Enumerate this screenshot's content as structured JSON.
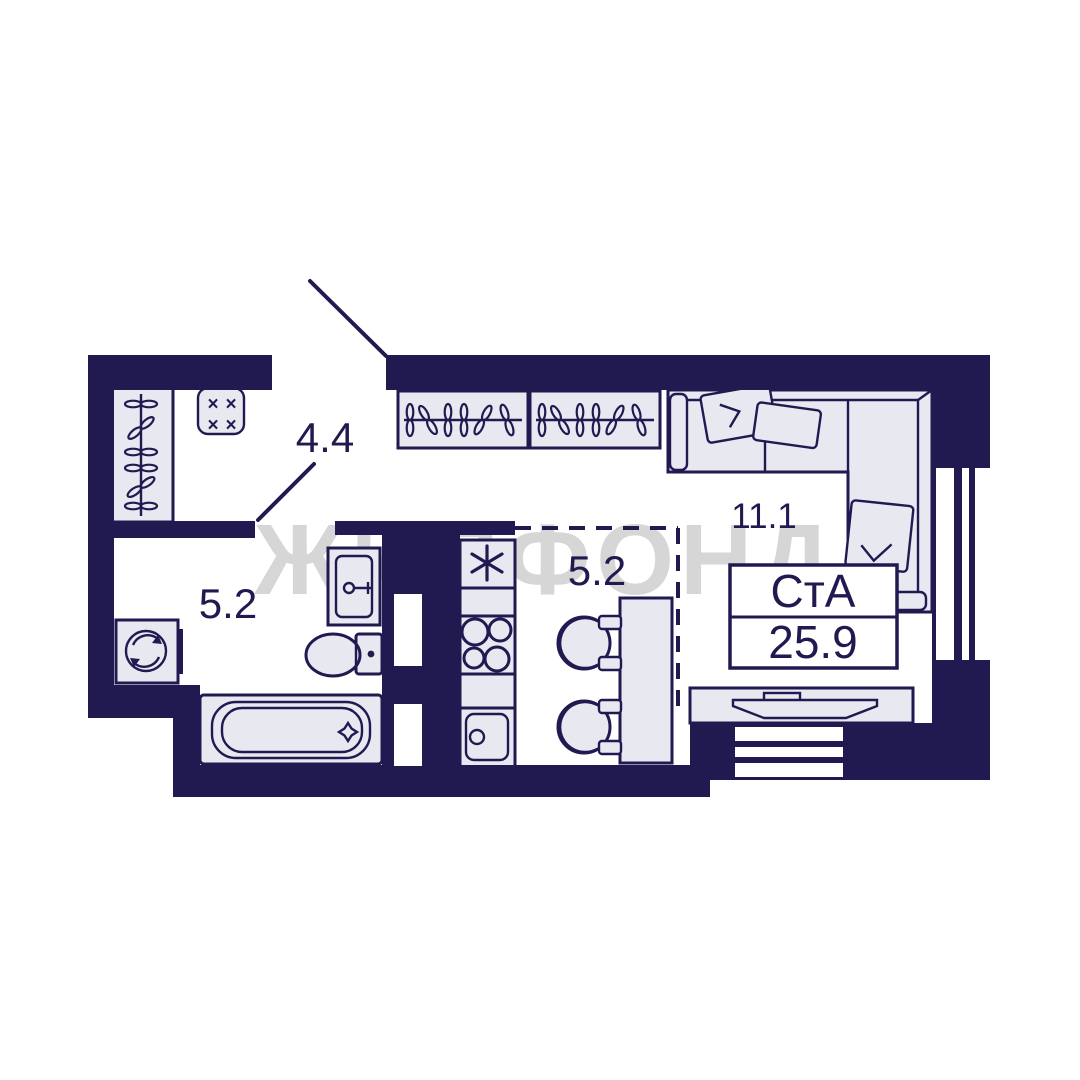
{
  "plan": {
    "watermark": "ЖИЛФОНД",
    "unit": {
      "type_label": "СтА",
      "total_area": "25.9"
    },
    "rooms": {
      "hallway": {
        "label": "4.4"
      },
      "bathroom": {
        "label": "5.2"
      },
      "kitchen": {
        "label": "5.2"
      },
      "living": {
        "label": "11.1"
      }
    },
    "icons": {
      "panel_cross": "×"
    },
    "colors": {
      "wall": "#211a51",
      "furn": "#e8e8f1",
      "floor": "#ffffff",
      "watermark": "#d6d6d6",
      "box": "#ffffff"
    }
  }
}
